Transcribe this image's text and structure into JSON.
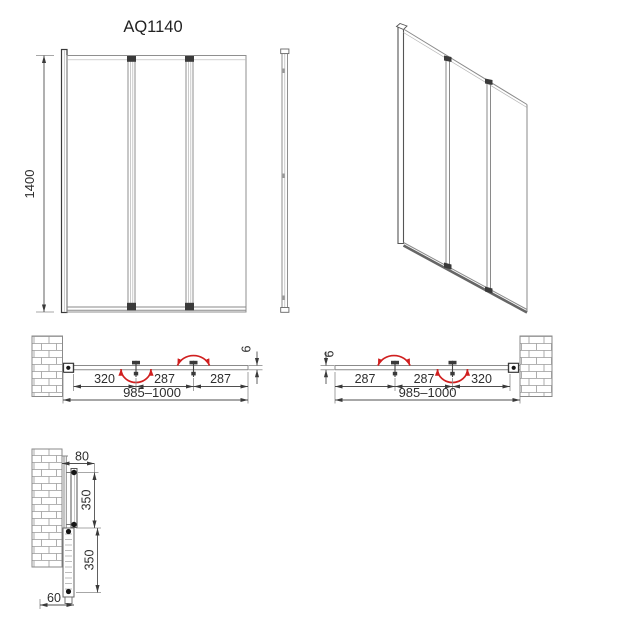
{
  "title": "AQ1140",
  "front_view": {
    "height": "1400"
  },
  "plan_left": {
    "seg1": "320",
    "seg2": "287",
    "seg3": "287",
    "overall": "985–1000",
    "thickness": "6"
  },
  "plan_right": {
    "seg1": "287",
    "seg2": "287",
    "seg3": "320",
    "overall": "985–1000",
    "thickness": "6"
  },
  "detail": {
    "offset": "80",
    "upper": "350",
    "lower": "350",
    "bottom": "60"
  },
  "colors": {
    "arrow_red": "#d01f1f",
    "line_gray": "#8a8a8a",
    "line_dark": "#3a3a3a",
    "text": "#2e2e2e"
  }
}
